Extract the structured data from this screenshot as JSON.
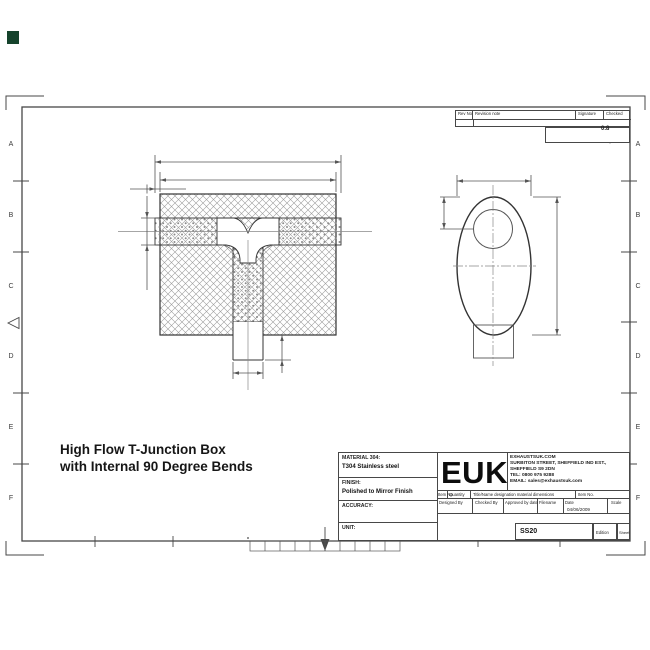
{
  "drawing_title": {
    "line1": "High Flow T-Junction Box",
    "line2": "with Internal 90 Degree Bends"
  },
  "title_block": {
    "material_label": "MATERIAL 304:",
    "material_value": "T304 Stainless steel",
    "finish_label": "FINISH:",
    "finish_value": "Polished to Mirror Finish",
    "accuracy_label": "ACCURACY:",
    "unit_label": "UNIT:",
    "logo": "EUK",
    "company": {
      "line1": "EXHAUSTSUK.COM",
      "line2": "SURBITON STREET, SHEFFIELD IND EST.,",
      "line3": "SHEFFIELD S9 2DN",
      "line4": "TEL: 0800 975 9288",
      "line5": "EMAIL: sales@exhaustsuk.com"
    },
    "item_row": {
      "item_no": "Item No",
      "quantity": "Quantity",
      "designation": "Title/Name designation material dimensions",
      "item_no2": "Item No."
    },
    "sign_row": {
      "designed": "Designed By",
      "checked": "Checked By",
      "approved": "Approved by date",
      "filename": "Filename",
      "date_label": "Date",
      "date_value": "04/06/2009",
      "scale": "Scale"
    },
    "doc_row": {
      "code": "SS20",
      "edition": "Edition",
      "sheet": "Sheet"
    }
  },
  "revision_table": {
    "rev_no": "Rev No",
    "revision_note": "Revision note",
    "signature": "Signature",
    "checked": "Checked"
  },
  "surface_finish": {
    "value": "0.8"
  },
  "border": {
    "row_letters": [
      "A",
      "B",
      "C",
      "D",
      "E",
      "F"
    ]
  },
  "colors": {
    "line": "#3c3c3c",
    "watermark": "#15432c"
  }
}
